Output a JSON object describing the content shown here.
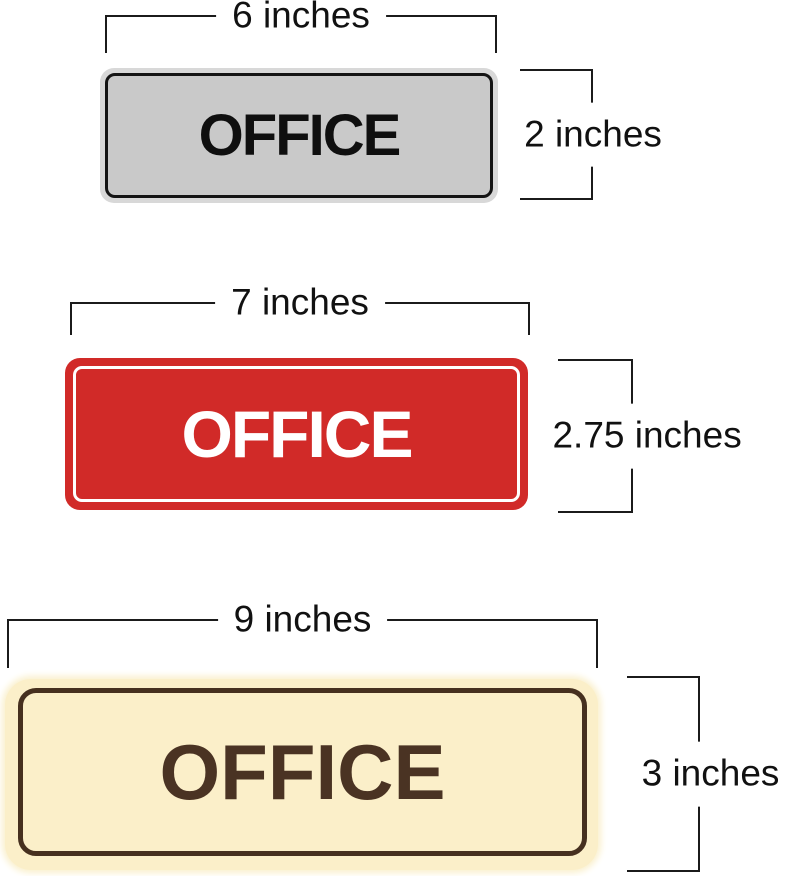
{
  "page": {
    "background": "#ffffff",
    "dimension_line_color": "#1b1b1b",
    "dimension_label_color": "#111111"
  },
  "signs": [
    {
      "name": "gray-office-sign",
      "label": "OFFICE",
      "width_label": "6 inches",
      "height_label": "2 inches",
      "width_in": 6,
      "height_in": 2,
      "colors": {
        "plate": "#c9c9c9",
        "rim": "#d8d8d8",
        "border": "#141414",
        "text": "#0f0f0f"
      }
    },
    {
      "name": "red-office-sign",
      "label": "OFFICE",
      "width_label": "7 inches",
      "height_label": "2.75 inches",
      "width_in": 7,
      "height_in": 2.75,
      "colors": {
        "plate": "#d12a28",
        "outline": "#ffffff",
        "text": "#ffffff"
      }
    },
    {
      "name": "cream-office-sign",
      "label": "OFFICE",
      "width_label": "9 inches",
      "height_label": "3 inches",
      "width_in": 9,
      "height_in": 3,
      "colors": {
        "plate": "#fbefc9",
        "border": "#46301f",
        "text": "#4a3323"
      }
    }
  ]
}
